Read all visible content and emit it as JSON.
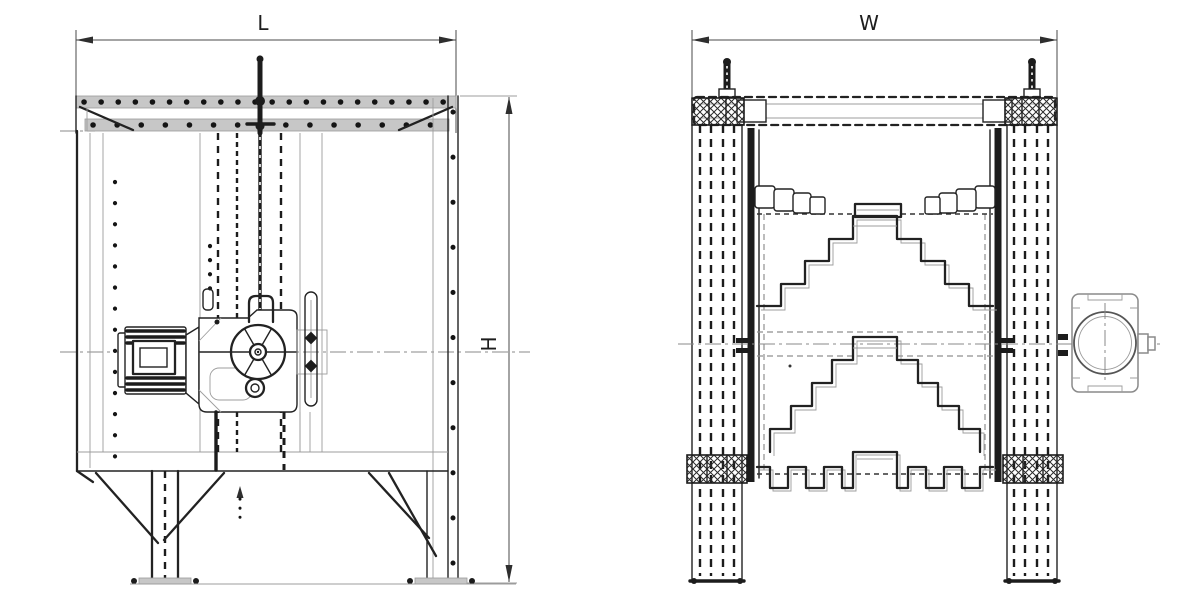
{
  "canvas": {
    "width": 1187,
    "height": 606,
    "background": "#ffffff"
  },
  "drawing": {
    "kind": "two-view engineering drawing",
    "ink_color": "#1f1f1f",
    "secondary_line_color": "#9b9b9b",
    "band_fill_color": "#c7c7c7",
    "views": {
      "front": {
        "name": "front view",
        "horizontal_dimension_label": "L",
        "vertical_dimension_label": "H"
      },
      "side": {
        "name": "side view",
        "horizontal_dimension_label": "W"
      }
    }
  }
}
